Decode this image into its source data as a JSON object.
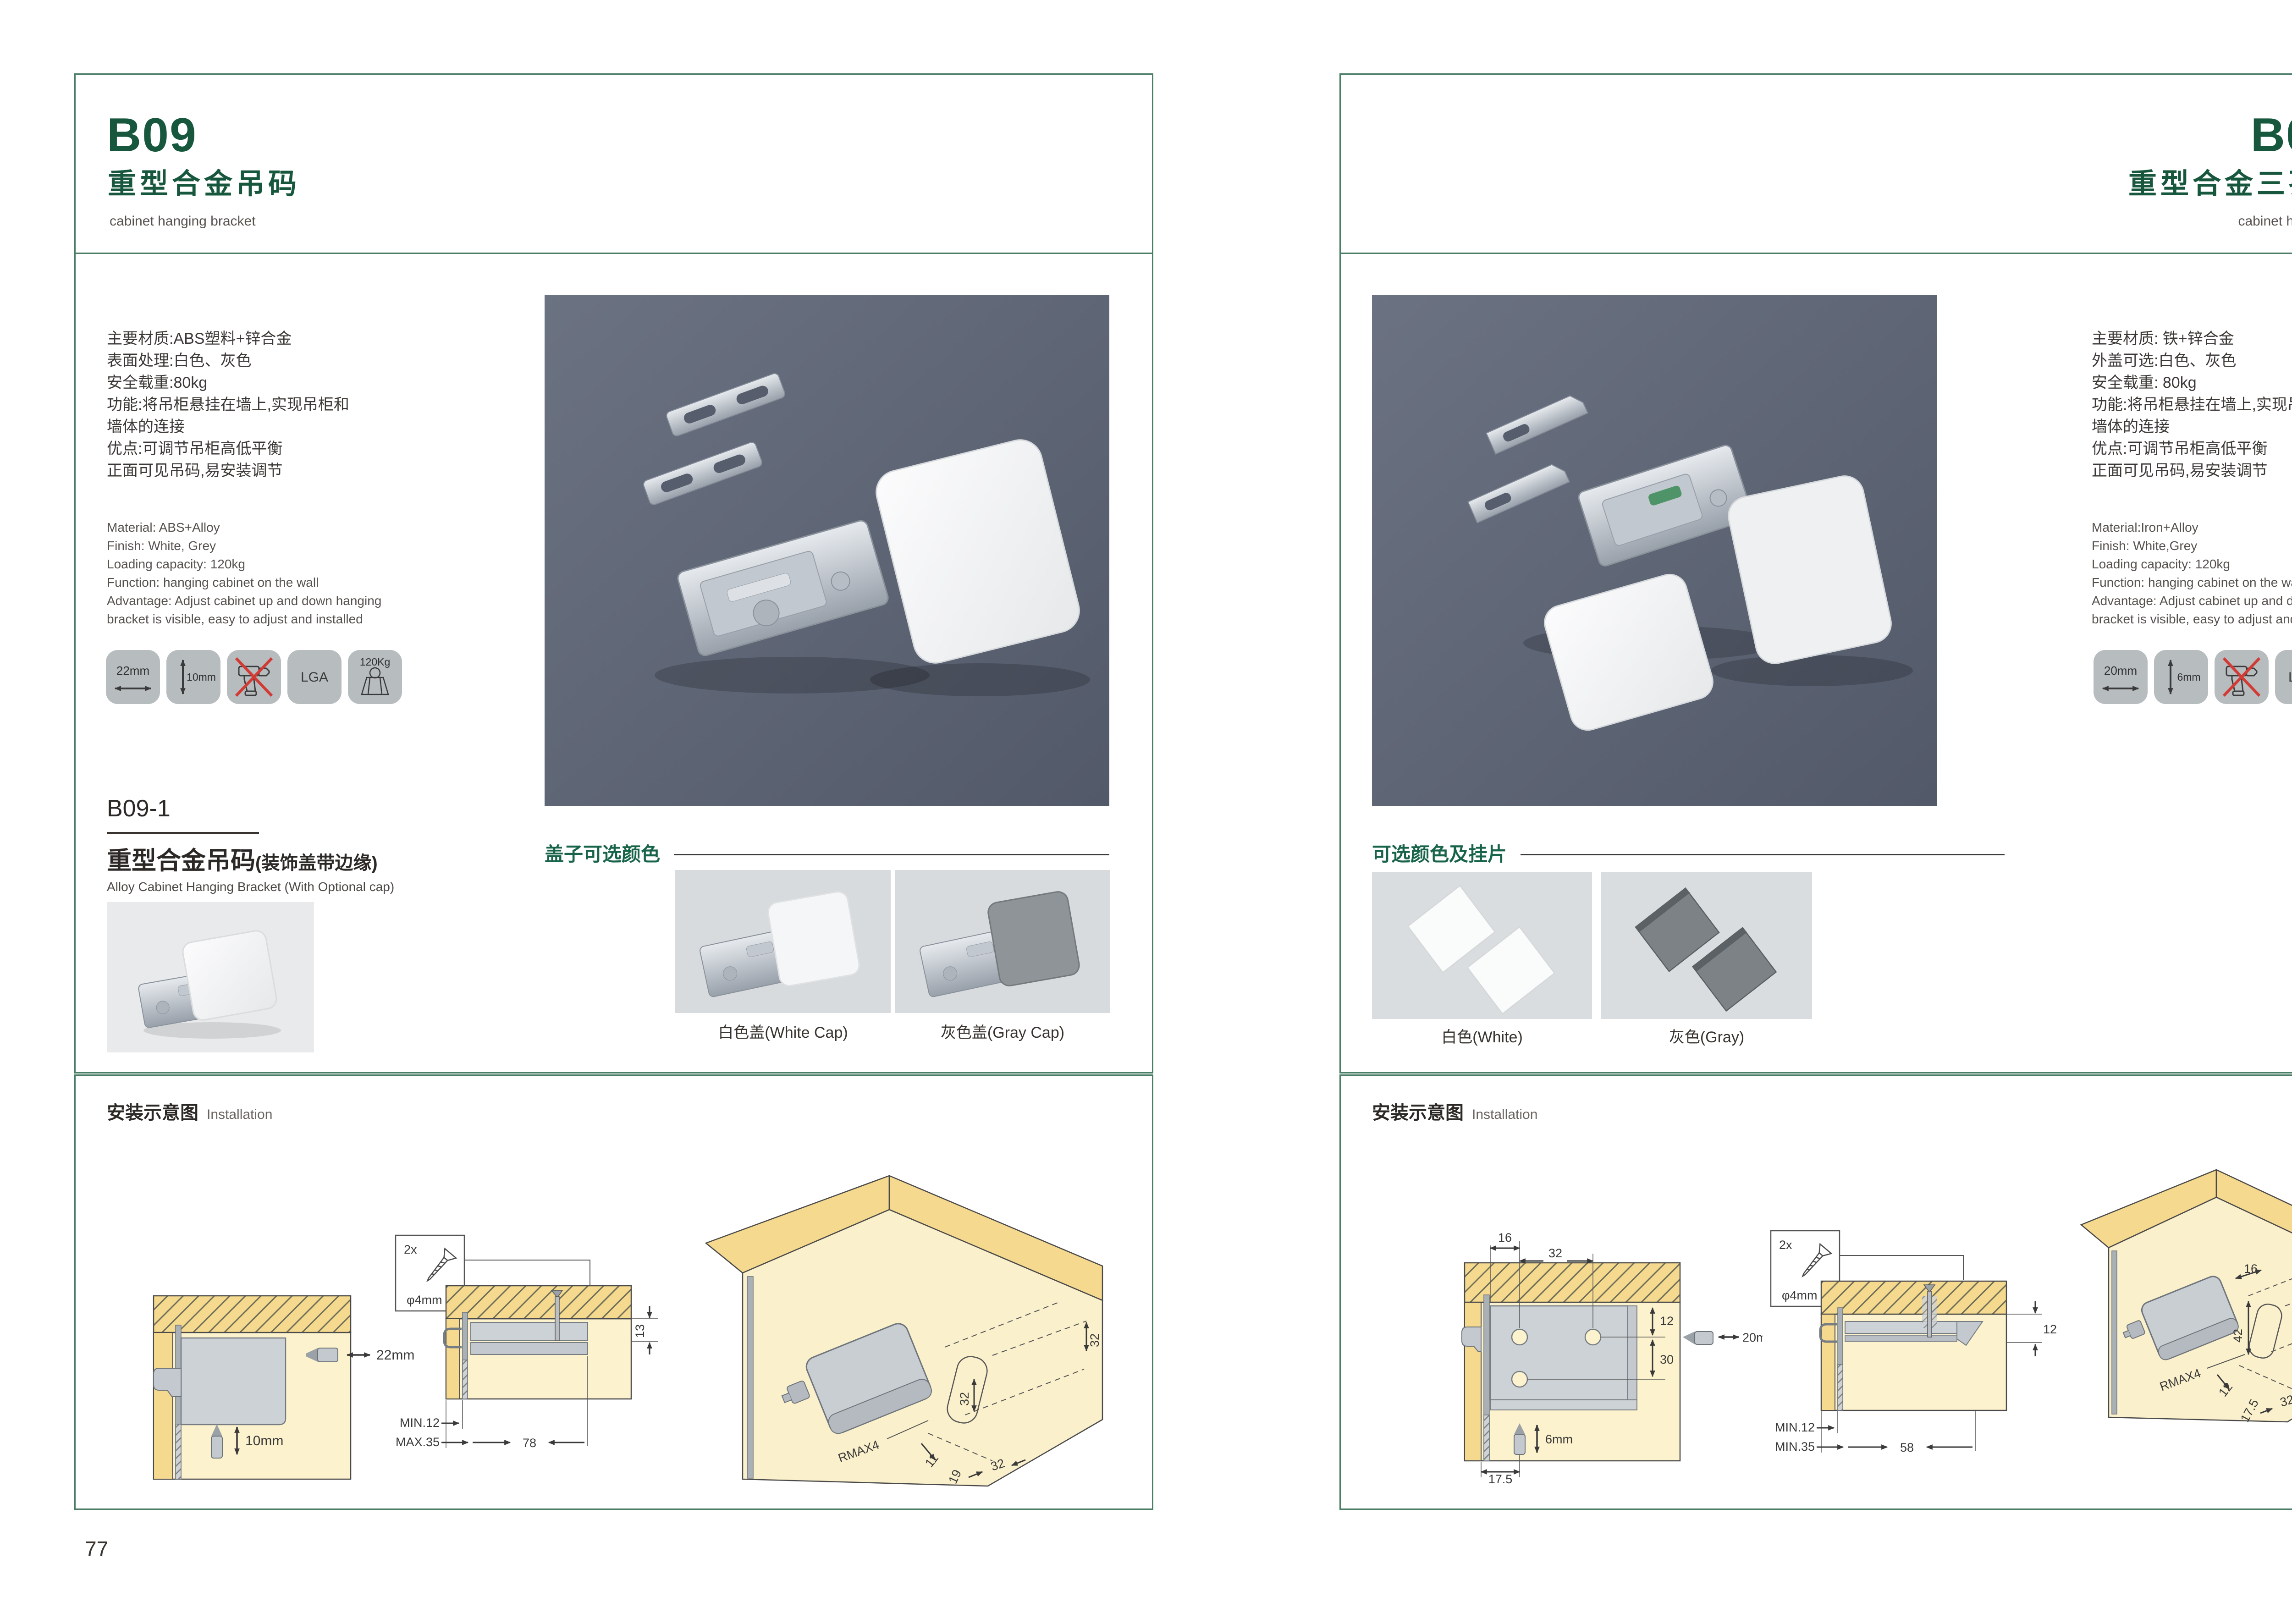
{
  "colors": {
    "accent_green": "#17573d",
    "border_green": "#4a7d66",
    "photo_bg": "#5d6473",
    "icon_tile": "#b7bcbf",
    "no_drill_red": "#d23a34"
  },
  "left": {
    "code": "B09",
    "title_cn": "重型合金吊码",
    "title_en": "cabinet hanging bracket",
    "specs_cn": "主要材质:ABS塑料+锌合金\n表面处理:白色、灰色\n安全载重:80kg\n功能:将吊柜悬挂在墙上,实现吊柜和\n墙体的连接\n优点:可调节吊柜高低平衡\n正面可见吊码,易安装调节",
    "specs_en": "Material: ABS+Alloy\nFinish: White, Grey\nLoading capacity: 120kg\nFunction: hanging cabinet on the wall\nAdvantage: Adjust cabinet up and down hanging\nbracket is visible, easy to adjust and installed",
    "icons": {
      "dim_w": "22mm",
      "dim_h": "10mm",
      "cert": "LGA",
      "load": "120Kg"
    },
    "sub": {
      "code": "B09-1",
      "cn_main": "重型合金吊码",
      "cn_paren": "(装饰盖带边缘)",
      "en": "Alloy Cabinet Hanging Bracket (With Optional cap)"
    },
    "caps": {
      "label": "盖子可选颜色",
      "cap1": "白色盖(White Cap)",
      "cap2": "灰色盖(Gray Cap)"
    },
    "install": {
      "heading_cn": "安装示意图",
      "heading_en": "Installation",
      "screw_qty": "2x",
      "screw_dia": "φ4mm",
      "d1_h": "22mm",
      "d1_v": "10mm",
      "d2_min": "MIN.12",
      "d2_max": "MAX.35",
      "d2_w": "78",
      "d2_h": "13",
      "d3_t": "32",
      "d3_m": "32",
      "d3_r": "RMAX4",
      "d3_a": "11",
      "d3_b": "19",
      "d3_c": "32"
    },
    "page_number": "77"
  },
  "right": {
    "code": "B09-3",
    "title_cn": "重型合金三孔吊码",
    "title_en": "cabinet hanging bracket",
    "specs_cn": "主要材质: 铁+锌合金\n外盖可选:白色、灰色\n安全载重: 80kg\n功能:将吊柜悬挂在墙上,实现吊柜和\n墙体的连接\n优点:可调节吊柜高低平衡\n正面可见吊码,易安装调节",
    "specs_en": "Material:Iron+Alloy\nFinish: White,Grey\nLoading capacity: 120kg\nFunction: hanging cabinet on the wall\nAdvantage: Adjust cabinet up and down hanging\nbracket is visible, easy to adjust and installed",
    "icons": {
      "dim_w": "20mm",
      "dim_h": "6mm",
      "cert": "LGA",
      "load": "120Kg"
    },
    "colors_opt": {
      "label": "可选颜色及挂片",
      "c1": "白色(White)",
      "c2": "灰色(Gray)"
    },
    "install": {
      "heading_cn": "安装示意图",
      "heading_en": "Installation",
      "screw_qty": "2x",
      "screw_dia": "φ4mm",
      "d1_t1": "16",
      "d1_t2": "32",
      "d1_r1": "12",
      "d1_r2": "30",
      "d1_h": "20mm",
      "d1_v": "6mm",
      "d1_b": "17.5",
      "d2_min": "MIN.12",
      "d2_max": "MIN.35",
      "d2_w": "58",
      "d2_h": "12",
      "d3_t": "16",
      "d3_r": "12",
      "d3_v": "42",
      "d3_rm": "RMAX4",
      "d3_a": "12",
      "d3_b": "17.5",
      "d3_c": "32"
    },
    "page_number": "78"
  }
}
